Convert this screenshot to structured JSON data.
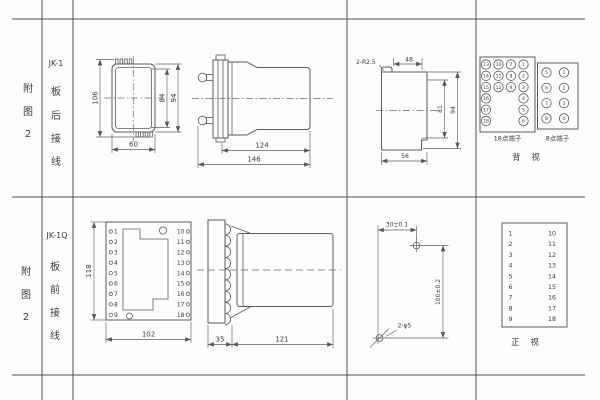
{
  "row1": {
    "fig": {
      "c1": "附",
      "c2": "图",
      "c3": "2"
    },
    "model": "JK-1",
    "wiring": {
      "c1": "板",
      "c2": "后",
      "c3": "接",
      "c4": "线"
    },
    "front_view": {
      "dim_overall_h": "106",
      "dim_inner_h": "84",
      "dim_case_h": "94",
      "dim_w": "60"
    },
    "side_view": {
      "dim_case_depth": "124",
      "dim_total_depth": "146"
    },
    "cutout": {
      "corner_note": "2-R2.5",
      "dim_top_w": "48",
      "dim_inner_h": "81",
      "dim_h": "94",
      "dim_w": "56"
    },
    "rear_panel": {
      "block18_label": "18点端子",
      "block8_label": "8点端子",
      "view_label": "背 视",
      "block18": {
        "col1": [
          "13",
          "14",
          "15",
          "16",
          "17",
          "18"
        ],
        "col2": [
          "10",
          "11",
          "12"
        ],
        "col3": [
          "7",
          "8",
          "9"
        ],
        "col4": [
          "1",
          "2",
          "3",
          "4",
          "5",
          "6"
        ]
      },
      "block8": {
        "col1": [
          "5",
          "6",
          "7",
          "8"
        ],
        "col2": [
          "1",
          "2",
          "3",
          "4"
        ]
      }
    }
  },
  "row2": {
    "fig": {
      "c1": "附",
      "c2": "图",
      "c3": "2"
    },
    "model": "JK-1Q",
    "wiring": {
      "c1": "板",
      "c2": "前",
      "c3": "接",
      "c4": "线"
    },
    "front_view": {
      "dim_h": "118",
      "dim_w": "102",
      "left_terminals": [
        "1",
        "2",
        "3",
        "4",
        "5",
        "6",
        "7",
        "8",
        "9"
      ],
      "right_terminals": [
        "10",
        "11",
        "12",
        "13",
        "14",
        "15",
        "16",
        "17",
        "18"
      ]
    },
    "side_view": {
      "dim_plate": "35",
      "dim_body": "121"
    },
    "drill_plan": {
      "dim_x": "30±0.1",
      "dim_y": "100±0.2",
      "holes_note": "2-φ5"
    },
    "front_panel": {
      "view_label": "正 视",
      "left": [
        "1",
        "2",
        "3",
        "4",
        "5",
        "6",
        "7",
        "8",
        "9"
      ],
      "right": [
        "10",
        "11",
        "12",
        "13",
        "14",
        "15",
        "16",
        "17",
        "18"
      ]
    }
  }
}
